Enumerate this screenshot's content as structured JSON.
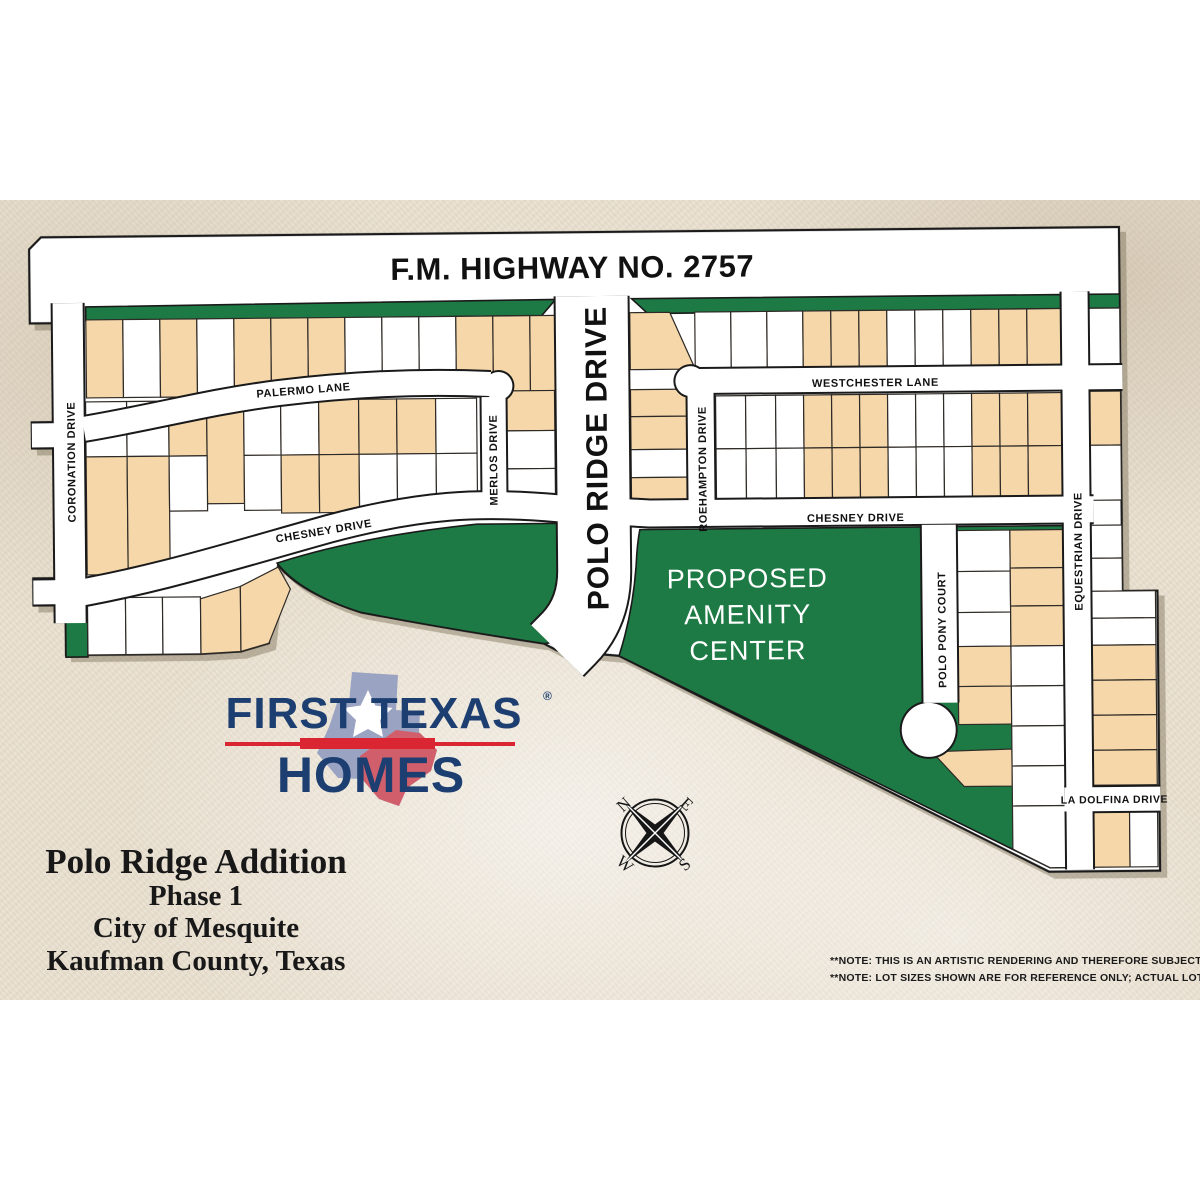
{
  "colors": {
    "background_band": "#e9e0d0",
    "map_white": "#ffffff",
    "outline_black": "#1a1a1a",
    "green_space": "#1e7a44",
    "lot_tan": "#f5d7aa",
    "logo_navy": "#1c3e70",
    "logo_red": "#da2533",
    "shadow": "#7d7059"
  },
  "map": {
    "highway": "F.M. HIGHWAY NO. 2757",
    "streets": {
      "coronation": "CORONATION DRIVE",
      "palermo": "PALERMO LANE",
      "merlos": "MERLOS DRIVE",
      "polo_ridge": "POLO RIDGE DRIVE",
      "chesney_west": "CHESNEY DRIVE",
      "chesney_east": "CHESNEY DRIVE",
      "westchester": "WESTCHESTER LANE",
      "roehampton": "ROEHAMPTON DRIVE",
      "polo_pony": "POLO PONY COURT",
      "equestrian": "EQUESTRIAN DRIVE",
      "la_dolfina": "LA DOLFINA DRIVE"
    },
    "amenity": [
      "PROPOSED",
      "AMENITY",
      "CENTER"
    ]
  },
  "compass": {
    "n": "N",
    "e": "E",
    "s": "S",
    "w": "W"
  },
  "logo": {
    "top": "FIRST TEXAS",
    "reg": "®",
    "bottom": "HOMES"
  },
  "title": [
    "Polo Ridge Addition",
    "Phase 1",
    "City of Mesquite",
    "Kaufman County, Texas"
  ],
  "notes": [
    "**NOTE: THIS IS AN ARTISTIC RENDERING AND THEREFORE SUBJECT TO CHANGE",
    "**NOTE: LOT SIZES SHOWN ARE FOR REFERENCE ONLY; ACTUAL LOT DIMENSIONS MAY VARY"
  ]
}
